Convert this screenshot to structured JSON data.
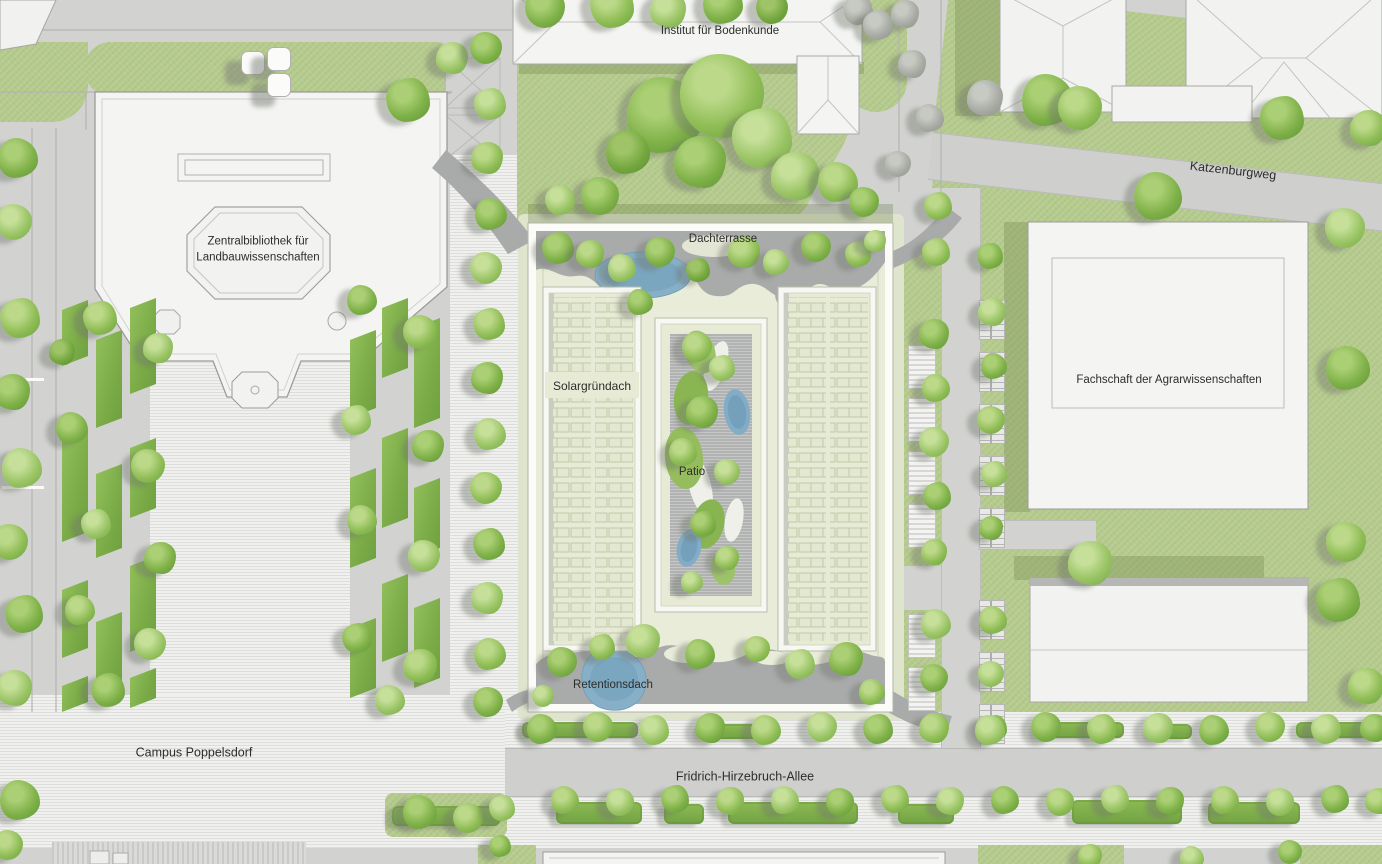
{
  "labels": {
    "institut": {
      "text": "Institut für Bodenkunde",
      "x": 720,
      "y": 32
    },
    "katzenburgweg": {
      "text": "Katzenburgweg",
      "x": 1233,
      "y": 171,
      "rot": 6.5
    },
    "bibliothek": {
      "text": "Zentralbibliothek für\nLandbauwissenschaften",
      "x": 258,
      "y": 250
    },
    "dachterrasse": {
      "text": "Dachterrasse",
      "x": 723,
      "y": 240
    },
    "solargruendach": {
      "text": "Solargründach",
      "x": 592,
      "y": 386
    },
    "patio": {
      "text": "Patio",
      "x": 692,
      "y": 473
    },
    "fachschaft": {
      "text": "Fachschaft der Agrarwissenschaften",
      "x": 1169,
      "y": 381
    },
    "retentionsdach": {
      "text": "Retentionsdach",
      "x": 613,
      "y": 686
    },
    "campus": {
      "text": "Campus Poppelsdorf",
      "x": 194,
      "y": 753
    },
    "allee": {
      "text": "Fridrich-Hirzebruch-Allee",
      "x": 745,
      "y": 777
    }
  },
  "palette": {
    "pavement": "#d2d3d1",
    "plaza": "#ececea",
    "lawn": "#b6cb8e",
    "roof_green": "#e9ecd9",
    "terrace_gray": "#a9abaa",
    "pond_blue": "#87b0c8",
    "building_white": "#f4f4f2",
    "tree_green": "#8fbd55",
    "hedge_green": "#7aab47"
  },
  "map": {
    "tree_tones": [
      [
        "#bcd98a",
        "#8fbd55",
        "#679f3f"
      ],
      [
        "#aacf74",
        "#7fb148",
        "#5d9338"
      ],
      [
        "#c6e09a",
        "#9ac465",
        "#74a844"
      ],
      [
        "#9fc468",
        "#74a83f",
        "#558c30"
      ],
      [
        "#cfe2a4",
        "#a8cb72",
        "#82ab4c"
      ],
      [
        "#c7cac3",
        "#a7aba3",
        "#8b9089"
      ]
    ],
    "trees": [
      [
        545,
        8,
        20,
        1
      ],
      [
        612,
        6,
        22,
        0
      ],
      [
        668,
        10,
        18,
        2
      ],
      [
        723,
        4,
        20,
        1
      ],
      [
        772,
        8,
        16,
        3
      ],
      [
        858,
        10,
        15,
        5
      ],
      [
        905,
        14,
        14,
        5
      ],
      [
        665,
        115,
        38,
        1
      ],
      [
        722,
        96,
        42,
        0
      ],
      [
        762,
        138,
        30,
        2
      ],
      [
        700,
        162,
        26,
        1
      ],
      [
        628,
        152,
        22,
        3
      ],
      [
        600,
        196,
        19,
        1
      ],
      [
        560,
        200,
        15,
        2
      ],
      [
        795,
        176,
        24,
        2
      ],
      [
        838,
        182,
        20,
        0
      ],
      [
        864,
        202,
        15,
        1
      ],
      [
        878,
        25,
        15,
        5
      ],
      [
        912,
        64,
        14,
        5
      ],
      [
        930,
        118,
        14,
        5
      ],
      [
        898,
        164,
        13,
        5
      ],
      [
        938,
        206,
        14,
        0
      ],
      [
        985,
        98,
        18,
        5
      ],
      [
        1048,
        100,
        26,
        1
      ],
      [
        1080,
        108,
        22,
        0
      ],
      [
        1282,
        118,
        22,
        1
      ],
      [
        1368,
        128,
        18,
        0
      ],
      [
        1158,
        196,
        24,
        1
      ],
      [
        1345,
        228,
        20,
        2
      ],
      [
        408,
        100,
        22,
        1
      ],
      [
        452,
        58,
        16,
        2
      ],
      [
        18,
        158,
        20,
        1
      ],
      [
        14,
        222,
        18,
        2
      ],
      [
        20,
        318,
        20,
        0
      ],
      [
        12,
        392,
        18,
        1
      ],
      [
        22,
        468,
        20,
        2
      ],
      [
        10,
        542,
        18,
        0
      ],
      [
        24,
        614,
        19,
        1
      ],
      [
        14,
        688,
        18,
        2
      ],
      [
        20,
        800,
        20,
        1
      ],
      [
        8,
        845,
        15,
        0
      ],
      [
        100,
        318,
        17,
        0
      ],
      [
        158,
        348,
        15,
        2
      ],
      [
        72,
        428,
        16,
        1
      ],
      [
        148,
        466,
        17,
        0
      ],
      [
        96,
        524,
        15,
        2
      ],
      [
        160,
        558,
        16,
        1
      ],
      [
        80,
        610,
        15,
        0
      ],
      [
        150,
        644,
        16,
        2
      ],
      [
        108,
        690,
        17,
        1
      ],
      [
        62,
        352,
        13,
        3
      ],
      [
        362,
        300,
        15,
        1
      ],
      [
        420,
        332,
        17,
        0
      ],
      [
        356,
        420,
        15,
        2
      ],
      [
        428,
        446,
        16,
        1
      ],
      [
        362,
        520,
        15,
        0
      ],
      [
        424,
        556,
        16,
        2
      ],
      [
        357,
        638,
        15,
        1
      ],
      [
        420,
        666,
        17,
        0
      ],
      [
        390,
        700,
        15,
        2
      ],
      [
        486,
        48,
        16,
        1
      ],
      [
        490,
        104,
        16,
        2
      ],
      [
        487,
        158,
        16,
        0
      ],
      [
        491,
        214,
        16,
        1
      ],
      [
        486,
        268,
        16,
        2
      ],
      [
        489,
        324,
        16,
        0
      ],
      [
        487,
        378,
        16,
        1
      ],
      [
        490,
        434,
        16,
        2
      ],
      [
        486,
        488,
        16,
        0
      ],
      [
        489,
        544,
        16,
        1
      ],
      [
        487,
        598,
        16,
        2
      ],
      [
        490,
        654,
        16,
        0
      ],
      [
        488,
        702,
        15,
        1
      ],
      [
        558,
        248,
        16,
        1
      ],
      [
        590,
        254,
        14,
        0
      ],
      [
        622,
        268,
        14,
        2
      ],
      [
        660,
        252,
        15,
        1
      ],
      [
        698,
        270,
        12,
        3
      ],
      [
        744,
        252,
        16,
        0
      ],
      [
        776,
        262,
        13,
        2
      ],
      [
        816,
        247,
        15,
        1
      ],
      [
        858,
        254,
        13,
        0
      ],
      [
        875,
        241,
        11,
        2
      ],
      [
        640,
        302,
        13,
        1
      ],
      [
        697,
        347,
        15,
        0
      ],
      [
        722,
        368,
        13,
        2
      ],
      [
        702,
        412,
        16,
        1
      ],
      [
        683,
        452,
        14,
        0
      ],
      [
        727,
        472,
        13,
        2
      ],
      [
        703,
        524,
        13,
        1
      ],
      [
        727,
        558,
        12,
        0
      ],
      [
        692,
        582,
        11,
        2
      ],
      [
        562,
        662,
        15,
        1
      ],
      [
        602,
        647,
        13,
        0
      ],
      [
        643,
        641,
        17,
        2
      ],
      [
        700,
        654,
        15,
        1
      ],
      [
        757,
        649,
        13,
        0
      ],
      [
        800,
        664,
        15,
        2
      ],
      [
        846,
        659,
        17,
        1
      ],
      [
        872,
        692,
        13,
        0
      ],
      [
        543,
        696,
        11,
        2
      ],
      [
        936,
        252,
        14,
        0
      ],
      [
        934,
        334,
        15,
        1
      ],
      [
        936,
        388,
        14,
        0
      ],
      [
        934,
        442,
        15,
        2
      ],
      [
        937,
        496,
        14,
        1
      ],
      [
        934,
        552,
        13,
        0
      ],
      [
        936,
        624,
        15,
        2
      ],
      [
        934,
        678,
        14,
        1
      ],
      [
        990,
        256,
        13,
        1
      ],
      [
        992,
        312,
        14,
        2
      ],
      [
        994,
        366,
        13,
        1
      ],
      [
        991,
        420,
        14,
        0
      ],
      [
        994,
        474,
        13,
        2
      ],
      [
        991,
        528,
        12,
        1
      ],
      [
        993,
        620,
        14,
        0
      ],
      [
        991,
        674,
        13,
        2
      ],
      [
        994,
        728,
        13,
        1
      ],
      [
        1090,
        563,
        22,
        2
      ],
      [
        1348,
        368,
        22,
        1
      ],
      [
        1346,
        542,
        20,
        0
      ],
      [
        1338,
        600,
        22,
        1
      ],
      [
        1366,
        686,
        18,
        0
      ],
      [
        542,
        729,
        15,
        1
      ],
      [
        598,
        727,
        15,
        0
      ],
      [
        654,
        730,
        15,
        2
      ],
      [
        710,
        728,
        15,
        1
      ],
      [
        766,
        730,
        15,
        0
      ],
      [
        822,
        727,
        15,
        2
      ],
      [
        878,
        729,
        15,
        1
      ],
      [
        934,
        728,
        15,
        0
      ],
      [
        990,
        730,
        15,
        2
      ],
      [
        1046,
        727,
        15,
        1
      ],
      [
        1102,
        729,
        15,
        0
      ],
      [
        1158,
        728,
        15,
        2
      ],
      [
        1214,
        730,
        15,
        1
      ],
      [
        1270,
        727,
        15,
        0
      ],
      [
        1326,
        729,
        15,
        2
      ],
      [
        1374,
        728,
        14,
        1
      ],
      [
        565,
        800,
        14,
        0
      ],
      [
        620,
        802,
        14,
        2
      ],
      [
        675,
        799,
        14,
        1
      ],
      [
        730,
        801,
        14,
        0
      ],
      [
        785,
        800,
        14,
        2
      ],
      [
        840,
        802,
        14,
        1
      ],
      [
        895,
        799,
        14,
        0
      ],
      [
        950,
        801,
        14,
        2
      ],
      [
        1005,
        800,
        14,
        1
      ],
      [
        1060,
        802,
        14,
        0
      ],
      [
        1115,
        799,
        14,
        2
      ],
      [
        1170,
        801,
        14,
        1
      ],
      [
        1225,
        800,
        14,
        0
      ],
      [
        1280,
        802,
        14,
        2
      ],
      [
        1335,
        799,
        14,
        1
      ],
      [
        1378,
        801,
        13,
        0
      ],
      [
        420,
        812,
        17,
        1
      ],
      [
        468,
        818,
        15,
        0
      ],
      [
        502,
        808,
        13,
        2
      ],
      [
        1090,
        856,
        12,
        0
      ],
      [
        1192,
        858,
        12,
        2
      ],
      [
        1290,
        852,
        12,
        1
      ],
      [
        500,
        846,
        11,
        1
      ]
    ],
    "hedges_slant": [
      [
        62,
        300,
        26,
        66
      ],
      [
        62,
        430,
        26,
        112
      ],
      [
        62,
        580,
        26,
        78
      ],
      [
        62,
        676,
        26,
        36
      ],
      [
        96,
        330,
        26,
        98
      ],
      [
        96,
        464,
        26,
        94
      ],
      [
        96,
        612,
        26,
        86
      ],
      [
        130,
        298,
        26,
        96
      ],
      [
        130,
        438,
        26,
        80
      ],
      [
        130,
        556,
        26,
        96
      ],
      [
        130,
        668,
        26,
        40
      ],
      [
        350,
        330,
        26,
        88
      ],
      [
        350,
        468,
        26,
        100
      ],
      [
        350,
        618,
        26,
        80
      ],
      [
        382,
        298,
        26,
        80
      ],
      [
        382,
        428,
        26,
        100
      ],
      [
        382,
        574,
        26,
        88
      ],
      [
        414,
        318,
        26,
        110
      ],
      [
        414,
        478,
        26,
        80
      ],
      [
        414,
        598,
        26,
        90
      ]
    ],
    "hedges_round": [
      [
        522,
        722,
        116,
        16
      ],
      [
        700,
        724,
        66,
        15
      ],
      [
        1036,
        722,
        88,
        16
      ],
      [
        1150,
        724,
        42,
        15
      ],
      [
        1296,
        722,
        86,
        16
      ],
      [
        556,
        802,
        86,
        22
      ],
      [
        664,
        804,
        40,
        20
      ],
      [
        728,
        802,
        130,
        22
      ],
      [
        898,
        804,
        56,
        20
      ],
      [
        1072,
        800,
        110,
        24
      ],
      [
        1208,
        802,
        92,
        22
      ],
      [
        392,
        806,
        108,
        20
      ]
    ],
    "racks_a": [
      [
        908,
        345
      ],
      [
        908,
        398
      ],
      [
        908,
        451
      ],
      [
        908,
        504
      ],
      [
        908,
        614
      ],
      [
        908,
        667
      ]
    ],
    "racks_b": [
      [
        979,
        300
      ],
      [
        979,
        352
      ],
      [
        979,
        404
      ],
      [
        979,
        456
      ],
      [
        979,
        508
      ],
      [
        979,
        600
      ],
      [
        979,
        652
      ],
      [
        979,
        704
      ]
    ],
    "skylights": [
      [
        252,
        62
      ],
      [
        278,
        58
      ],
      [
        278,
        84
      ]
    ],
    "parking_dashes": [
      [
        2,
        378,
        42,
        3
      ],
      [
        2,
        486,
        42,
        3
      ]
    ]
  }
}
